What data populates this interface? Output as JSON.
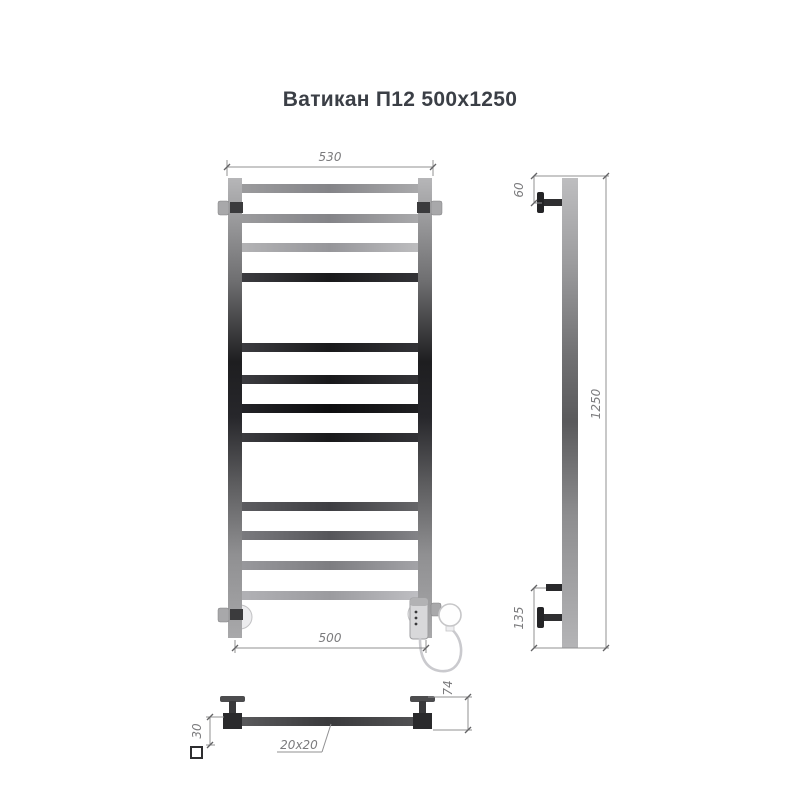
{
  "title": "Ватикан П12 500x1250",
  "dimensions": {
    "top_width": "530",
    "bottom_width": "500",
    "height": "1250",
    "top_bracket_offset": "60",
    "bottom_bracket_offset": "135",
    "bracket_depth": "30",
    "wall_depth": "74",
    "tube_profile": "20x20"
  },
  "icons": {
    "square_profile_icon": "square-outline"
  },
  "colors": {
    "title_text": "#3b3f46",
    "dimension_lines": "#909092",
    "dimension_text": "#7b7b7d",
    "chrome_light": "#b5b5b7",
    "chrome_mid": "#77777b",
    "chrome_dark": "#141416",
    "background": "#ffffff"
  }
}
